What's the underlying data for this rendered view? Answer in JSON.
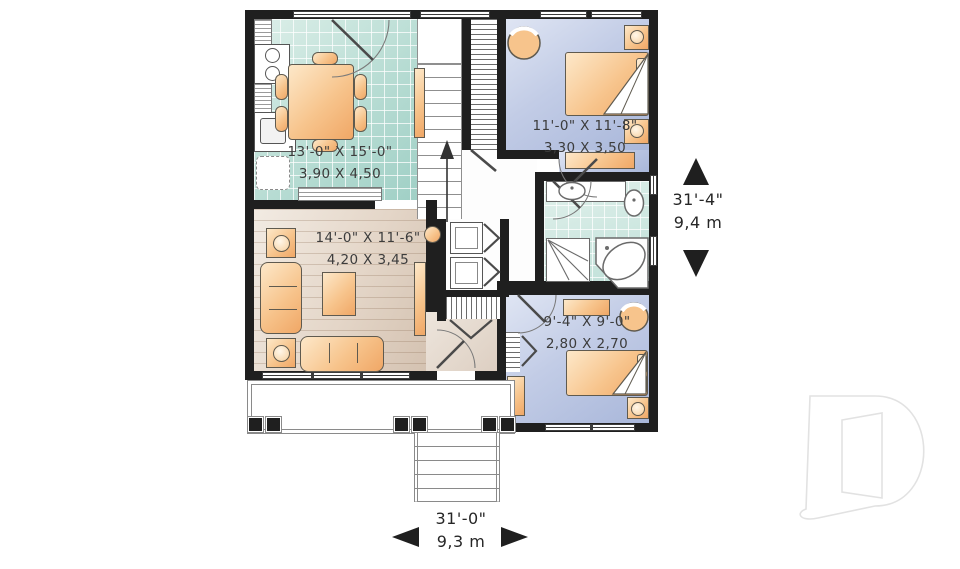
{
  "rooms": {
    "dining": {
      "imperial": "13'-0\" X 15'-0\"",
      "metric": "3,90 X 4,50"
    },
    "bedroom_top": {
      "imperial": "11'-0\" X 11'-8\"",
      "metric": "3,30 X 3,50"
    },
    "living": {
      "imperial": "14'-0\" X 11'-6\"",
      "metric": "4,20 X 3,45"
    },
    "bedroom_bottom": {
      "imperial": "9'-4\" X 9'-0\"",
      "metric": "2,80 X 2,70"
    }
  },
  "dimensions": {
    "depth": {
      "imperial": "31'-4\"",
      "metric": "9,4 m"
    },
    "width": {
      "imperial": "31'-0\"",
      "metric": "9,3 m"
    }
  },
  "colors": {
    "wall": "#1f1f1f",
    "kitchen_tile": "#b7dcd3",
    "bath_tile": "#bfe0d8",
    "bedroom_floor": "#a9b7da",
    "living_floor": "#e4d6c8",
    "furniture": "#f7c48c",
    "label_text": "#3c3c3c",
    "logo_outline": "#e2e2e2"
  },
  "logo": {
    "shape": "stylized-letter-D"
  }
}
